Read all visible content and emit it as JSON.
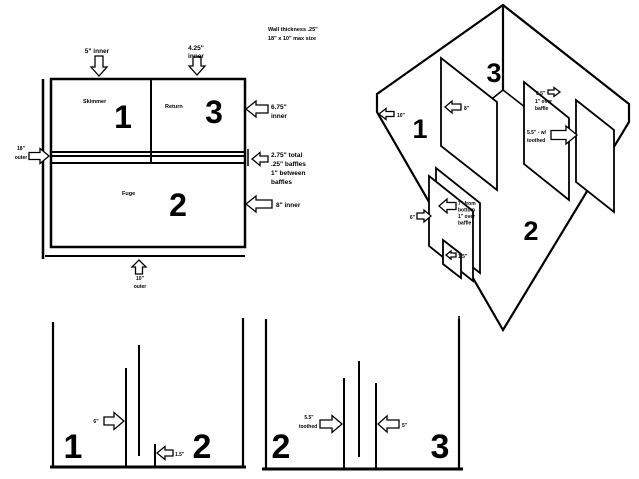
{
  "notes": {
    "wall_thickness": "Wall thickness .25\"",
    "max_size": "18\" x 10\" max size"
  },
  "plan_view": {
    "top_dim_1": "5\" inner",
    "top_dim_2_line1": "4.25\"",
    "top_dim_2_line2": "inner",
    "compartment_1_label": "Skimmer",
    "compartment_1_number": "1",
    "compartment_3_label": "Return",
    "compartment_3_number": "3",
    "compartment_2_label": "Fuge",
    "compartment_2_number": "2",
    "right_dim_1_line1": "6.75\"",
    "right_dim_1_line2": "inner",
    "left_dim_line1": "18\"",
    "left_dim_line2": "outer",
    "baffle_note_line1": "2.75\" total",
    "baffle_note_line2": ".25\" baffles",
    "baffle_note_line3": "1\" between",
    "baffle_note_line4": "baffles",
    "right_dim_2": "8\" inner",
    "bottom_dim_line1": "10\"",
    "bottom_dim_line2": "outer"
  },
  "iso_view": {
    "compartment_1_number": "1",
    "compartment_2_number": "2",
    "compartment_3_number": "3",
    "left_wall_dim": "10\"",
    "divider_dim": "8\"",
    "over_baffle_line1": "6.5\"",
    "over_baffle_line2": "1\" over",
    "over_baffle_line3": "baffle",
    "toothed_baffle_line1": "5.5\" - w/",
    "toothed_baffle_line2": "toothed",
    "baffle_6_dim": "6\"",
    "float_baffle_line1": "7\" from",
    "float_baffle_line2": "bottom",
    "float_baffle_line3": "1\" over",
    "float_baffle_line4": "baffle",
    "baffle_15_dim": "1.5\""
  },
  "elevation_left": {
    "compartment_1_number": "1",
    "compartment_2_number": "2",
    "baffle_6_dim": "6\"",
    "baffle_15_dim": "1.5\""
  },
  "elevation_right": {
    "compartment_2_number": "2",
    "compartment_3_number": "3",
    "toothed_line1": "5.5\"",
    "toothed_line2": "toothed",
    "baffle_5_dim": "5\""
  }
}
